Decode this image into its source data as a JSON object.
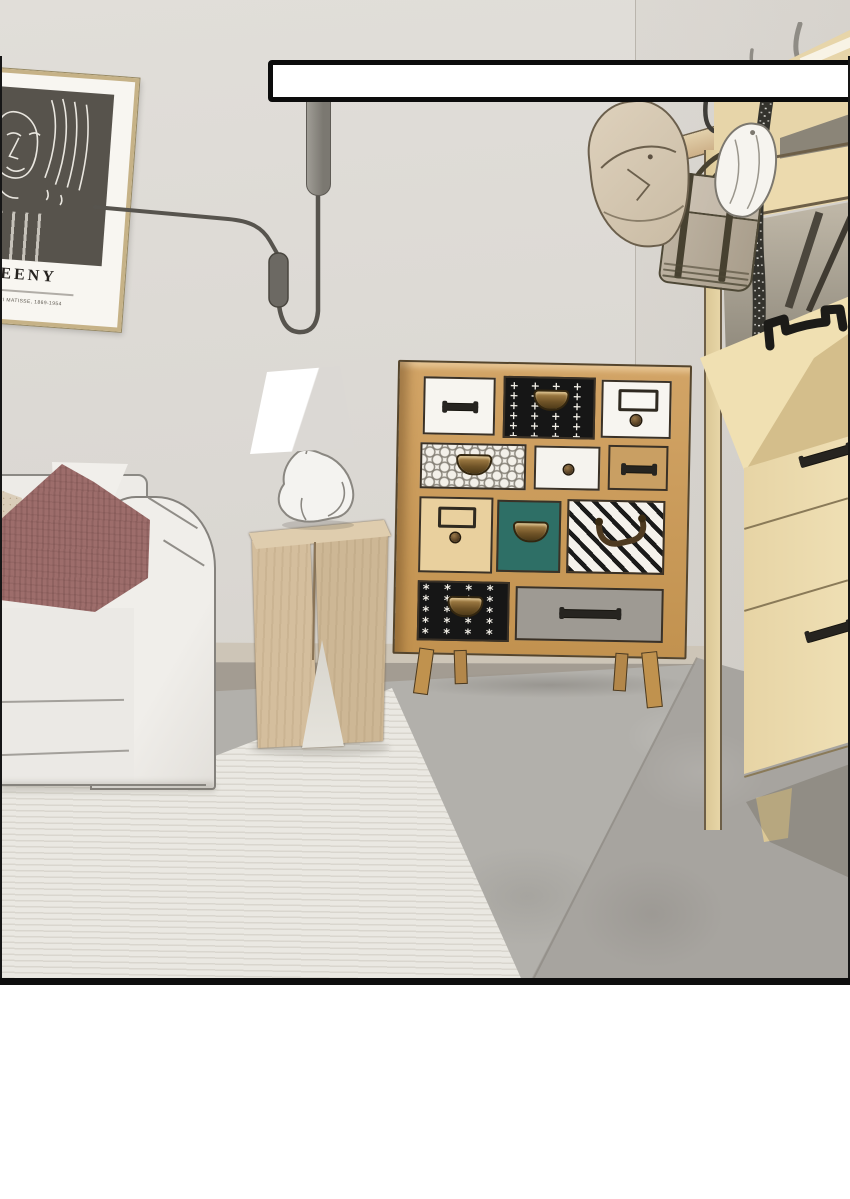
{
  "scene": {
    "kind": "illustrated interior comic panel",
    "objects": [
      "framed art poster",
      "wall cable lamp",
      "empty speech box",
      "coat rack with bucket hat, white cap and satchel",
      "polka-dot scarf",
      "tall shoe cabinet with open flap",
      "multi-drawer patchwork chest",
      "rabbit table lamp on wooden stool",
      "white sofa with cushions",
      "cream rug on concrete floor"
    ]
  },
  "speech_bubble": {
    "text": ""
  },
  "poster": {
    "title": "TEENY",
    "byline": "BY HENRI MATISSE, 1869-1954"
  },
  "colors": {
    "wall": "#dcd9d4",
    "floor_concrete": "#b2b0ab",
    "floor_concrete_dark": "#a7a49f",
    "rug": "#eae8e2",
    "baseboard_light": "#cdc5b7",
    "baseboard_dark": "#a39c92",
    "sofa": "#edebe7",
    "pillow_mauve": "#9d6d6b",
    "pillow_beige": "#dacdb9",
    "chest_wood": "#c6995e",
    "drawer_teal": "#2e6f66",
    "drawer_gray": "#9e9a93",
    "cabinet_wood": "#ecdbb0",
    "table_wood": "#d4be9d",
    "brass": "#8a6b3a",
    "outline": "#2a2722",
    "lamp_metal": "#8b8881",
    "scarf": "#34332d",
    "red_item": "#c23c31",
    "panel_border": "#0e0e0e"
  }
}
